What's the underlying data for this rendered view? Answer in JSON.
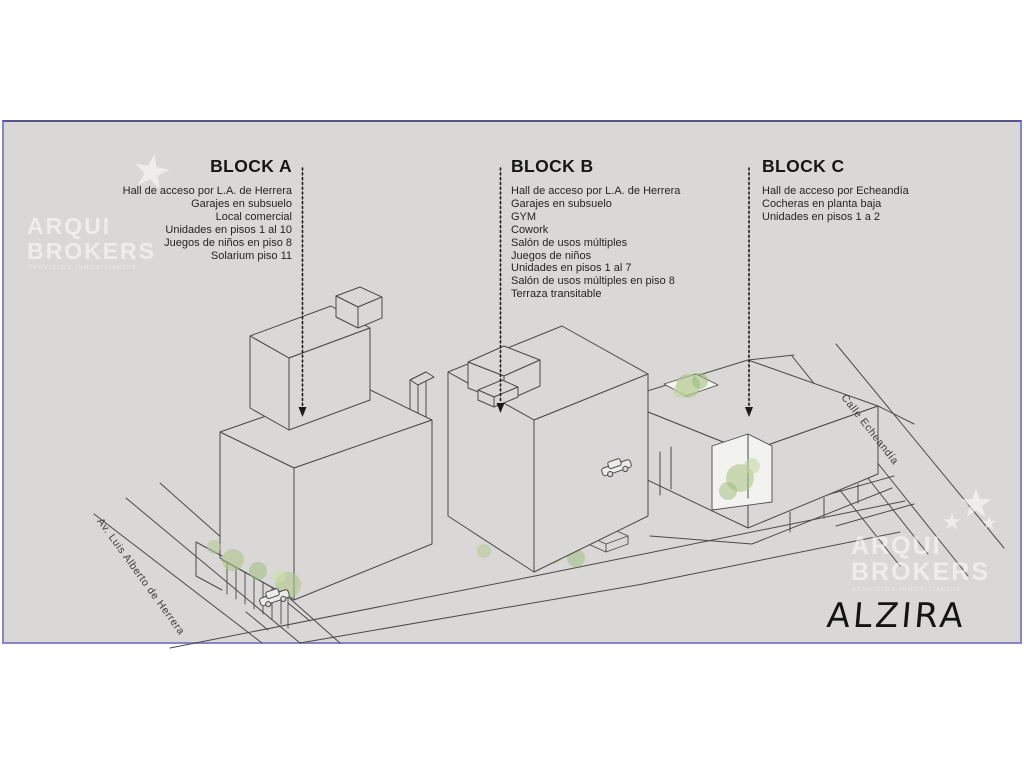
{
  "project": {
    "name": "ALZIRA"
  },
  "watermark": {
    "brand_line1": "ARQUI",
    "brand_line2": "BROKERS",
    "tagline": "SERVICIOS INMOBILIARIOS",
    "star_glyph": "★"
  },
  "blocks": [
    {
      "title": "BLOCK A",
      "features": [
        "Hall de acceso por L.A. de Herrera",
        "Garajes en subsuelo",
        "Local comercial",
        "Unidades en pisos 1 al 10",
        "Juegos de niños en piso 8",
        "Solarium piso 11"
      ]
    },
    {
      "title": "BLOCK B",
      "features": [
        "Hall de acceso por L.A. de Herrera",
        "Garajes en subsuelo",
        "GYM",
        "Cowork",
        "Salón de usos múltiples",
        "Juegos de niños",
        "Unidades en pisos 1 al 7",
        "Salón de usos múltiples en piso 8",
        "Terraza transitable"
      ]
    },
    {
      "title": "BLOCK C",
      "features": [
        "Hall de acceso por Echeandía",
        "Cocheras en planta baja",
        "Unidades en pisos 1 a 2"
      ]
    }
  ],
  "streets": [
    {
      "name": "Av. Luis Alberto de Herrera"
    },
    {
      "name": "Calle Echeandía"
    }
  ],
  "signature": "ALZIRA",
  "colors": {
    "panel_bg": "#d9d8d6",
    "line": "#4a4a48",
    "border": "#8585c8",
    "tree_green": "#a9c487",
    "text": "#1d1d1d",
    "watermark": "rgba(255,255,255,0.55)"
  }
}
